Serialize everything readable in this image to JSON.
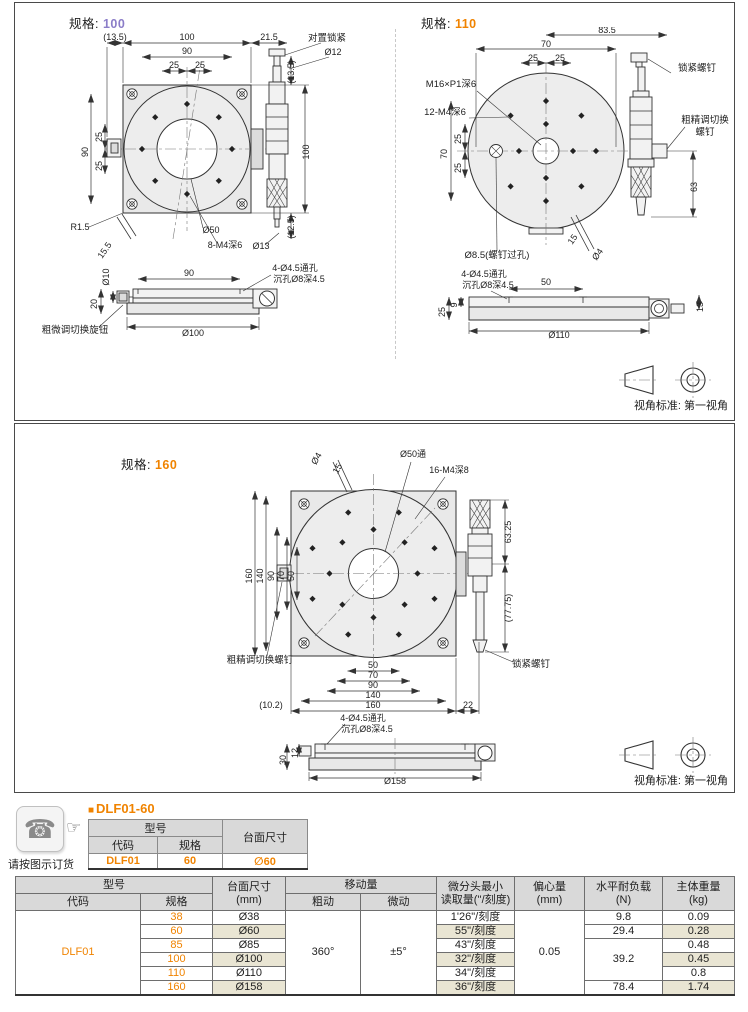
{
  "colors": {
    "accent_orange": "#f08300",
    "accent_purple": "#8b7dc8",
    "row_highlight": "#e9e5d3",
    "header_gray": "#d9d9d9"
  },
  "sections": {
    "spec100": {
      "label": "规格:",
      "value": "100"
    },
    "spec110": {
      "label": "规格:",
      "value": "110"
    },
    "spec160": {
      "label": "规格:",
      "value": "160"
    },
    "view_note": "视角标准: 第一视角"
  },
  "drawings": {
    "spec100_labels": [
      {
        "t": "(13.5)",
        "x": 82,
        "y": 13
      },
      {
        "t": "100",
        "x": 154,
        "y": 13
      },
      {
        "t": "21.5",
        "x": 236,
        "y": 13
      },
      {
        "t": "90",
        "x": 154,
        "y": 27
      },
      {
        "t": "25",
        "x": 141,
        "y": 41
      },
      {
        "t": "25",
        "x": 167,
        "y": 41
      },
      {
        "t": "对置锁紧",
        "x": 294,
        "y": 14,
        "size": 9.5
      },
      {
        "t": "Ø12",
        "x": 300,
        "y": 28
      },
      {
        "t": "90",
        "x": 55,
        "y": 125,
        "rot": -90
      },
      {
        "t": "25",
        "x": 69,
        "y": 110,
        "rot": -90
      },
      {
        "t": "25",
        "x": 69,
        "y": 139,
        "rot": -90
      },
      {
        "t": "(13.5)",
        "x": 261,
        "y": 45,
        "rot": -90
      },
      {
        "t": "100",
        "x": 276,
        "y": 125,
        "rot": -90
      },
      {
        "t": "(12.5)",
        "x": 261,
        "y": 200,
        "rot": -90
      },
      {
        "t": "Ø13",
        "x": 228,
        "y": 222
      },
      {
        "t": "R1.5",
        "x": 47,
        "y": 203
      },
      {
        "t": "15.5",
        "x": 74,
        "y": 225,
        "rot": -55
      },
      {
        "t": "Ø50",
        "x": 178,
        "y": 206
      },
      {
        "t": "8-M4深6",
        "x": 192,
        "y": 221
      },
      {
        "t": "90",
        "x": 156,
        "y": 249
      },
      {
        "t": "4-Ø4.5通孔",
        "x": 262,
        "y": 244
      },
      {
        "t": "沉孔Ø8深4.5",
        "x": 266,
        "y": 255
      },
      {
        "t": "Ø10",
        "x": 76,
        "y": 250,
        "rot": -90
      },
      {
        "t": "20",
        "x": 64,
        "y": 277,
        "rot": -90
      },
      {
        "t": "Ø100",
        "x": 160,
        "y": 309
      },
      {
        "t": "粗微调切换旋钮",
        "x": 42,
        "y": 306,
        "size": 9.5
      }
    ],
    "spec110_labels": [
      {
        "t": "83.5",
        "x": 208,
        "y": 6
      },
      {
        "t": "70",
        "x": 147,
        "y": 20
      },
      {
        "t": "25",
        "x": 134,
        "y": 34
      },
      {
        "t": "25",
        "x": 161,
        "y": 34
      },
      {
        "t": "M16×P1深6",
        "x": 52,
        "y": 60,
        "size": 9.5
      },
      {
        "t": "12-M4深6",
        "x": 46,
        "y": 88,
        "size": 9.5
      },
      {
        "t": "锁紧螺钉",
        "x": 298,
        "y": 44,
        "size": 9.5
      },
      {
        "t": "粗精调切换",
        "x": 306,
        "y": 96,
        "size": 9.5
      },
      {
        "t": "螺钉",
        "x": 306,
        "y": 108,
        "size": 9.5
      },
      {
        "t": "70",
        "x": 48,
        "y": 127,
        "rot": -90
      },
      {
        "t": "25",
        "x": 62,
        "y": 112,
        "rot": -90
      },
      {
        "t": "25",
        "x": 62,
        "y": 141,
        "rot": -90
      },
      {
        "t": "63",
        "x": 298,
        "y": 160,
        "rot": -90
      },
      {
        "t": "Ø8.5(螺钉过孔)",
        "x": 98,
        "y": 231,
        "size": 9.5
      },
      {
        "t": "15",
        "x": 176,
        "y": 214,
        "rot": -55
      },
      {
        "t": "Ø4",
        "x": 201,
        "y": 229,
        "rot": -55
      },
      {
        "t": "4-Ø4.5通孔",
        "x": 85,
        "y": 250
      },
      {
        "t": "沉孔Ø8深4.5",
        "x": 89,
        "y": 261
      },
      {
        "t": "50",
        "x": 147,
        "y": 258
      },
      {
        "t": "25",
        "x": 46,
        "y": 285,
        "rot": -90
      },
      {
        "t": "9",
        "x": 58,
        "y": 278,
        "rot": -90
      },
      {
        "t": "13",
        "x": 304,
        "y": 280,
        "rot": -90
      },
      {
        "t": "Ø110",
        "x": 160,
        "y": 311
      }
    ],
    "spec160_labels": [
      {
        "t": "Ø4",
        "x": 304,
        "y": 36,
        "rot": -60
      },
      {
        "t": "15",
        "x": 325,
        "y": 46,
        "rot": -60
      },
      {
        "t": "Ø50通",
        "x": 398,
        "y": 33
      },
      {
        "t": "16-M4深8",
        "x": 434,
        "y": 49
      },
      {
        "t": "160",
        "x": 237,
        "y": 152,
        "rot": -90
      },
      {
        "t": "140",
        "x": 248,
        "y": 152,
        "rot": -90
      },
      {
        "t": "90",
        "x": 259,
        "y": 152,
        "rot": -90
      },
      {
        "t": "70",
        "x": 269,
        "y": 152,
        "rot": -90
      },
      {
        "t": "50",
        "x": 279,
        "y": 152,
        "rot": -90
      },
      {
        "t": "63.25",
        "x": 496,
        "y": 108,
        "rot": -90
      },
      {
        "t": "(77.75)",
        "x": 496,
        "y": 184,
        "rot": -90
      },
      {
        "t": "粗精调切换螺钉",
        "x": 245,
        "y": 239,
        "size": 9.5
      },
      {
        "t": "锁紧螺钉",
        "x": 516,
        "y": 243,
        "size": 9.5
      },
      {
        "t": "50",
        "x": 358,
        "y": 244
      },
      {
        "t": "70",
        "x": 358,
        "y": 254
      },
      {
        "t": "90",
        "x": 358,
        "y": 264
      },
      {
        "t": "140",
        "x": 358,
        "y": 274
      },
      {
        "t": "160",
        "x": 358,
        "y": 284
      },
      {
        "t": "(10.2)",
        "x": 256,
        "y": 284
      },
      {
        "t": "22",
        "x": 453,
        "y": 284
      },
      {
        "t": "4-Ø4.5通孔",
        "x": 348,
        "y": 297
      },
      {
        "t": "沉孔Ø8深4.5",
        "x": 352,
        "y": 308
      },
      {
        "t": "30",
        "x": 271,
        "y": 336,
        "rot": -90
      },
      {
        "t": "12",
        "x": 283,
        "y": 329,
        "rot": -90
      },
      {
        "t": "Ø158",
        "x": 380,
        "y": 360
      }
    ]
  },
  "order": {
    "bullet": "■",
    "title": "DLF01-60",
    "note": "请按图示订货",
    "icons": {
      "phone": "☎",
      "finger": "☞"
    },
    "headers": {
      "model": "型号",
      "code": "代码",
      "spec": "规格",
      "size": "台面尺寸"
    },
    "row": {
      "code": "DLF01",
      "spec": "60",
      "size": "∅60"
    }
  },
  "spec_table": {
    "headers": {
      "model": "型号",
      "code": "代码",
      "spec": "规格",
      "size1": "台面尺寸",
      "size2": "(mm)",
      "travel": "移动量",
      "coarse": "粗动",
      "fine": "微动",
      "micro1": "微分头最小",
      "micro2": "读取量(''/刻度)",
      "ecc1": "偏心量",
      "ecc2": "(mm)",
      "load1": "水平耐负载",
      "load2": "(N)",
      "weight1": "主体重量",
      "weight2": "(kg)"
    },
    "code": "DLF01",
    "coarse": "360°",
    "fine": "±5°",
    "ecc": "0.05",
    "rows": [
      {
        "spec": "38",
        "size": "Ø38",
        "reading": "1'26\"/刻度",
        "load": "9.8",
        "weight": "0.09"
      },
      {
        "spec": "60",
        "size": "Ø60",
        "reading": "55\"/刻度",
        "load": "29.4",
        "weight": "0.28"
      },
      {
        "spec": "85",
        "size": "Ø85",
        "reading": "43\"/刻度",
        "load": "39.2",
        "weight": "0.48"
      },
      {
        "spec": "100",
        "size": "Ø100",
        "reading": "32\"/刻度",
        "weight": "0.45"
      },
      {
        "spec": "110",
        "size": "Ø110",
        "reading": "34\"/刻度",
        "weight": "0.8"
      },
      {
        "spec": "160",
        "size": "Ø158",
        "reading": "36\"/刻度",
        "load": "78.4",
        "weight": "1.74"
      }
    ]
  }
}
